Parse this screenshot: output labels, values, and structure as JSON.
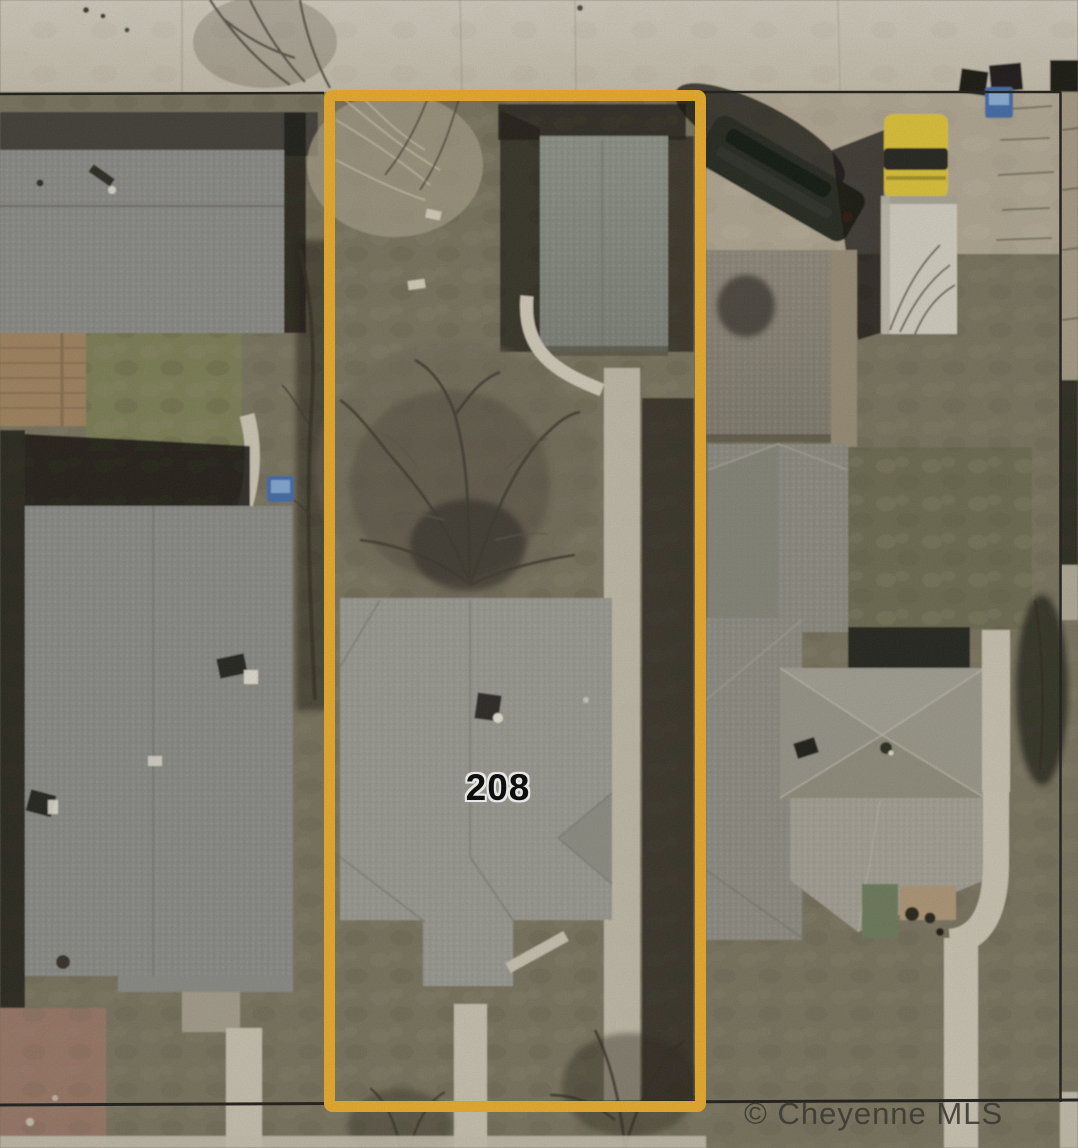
{
  "map": {
    "type": "aerial-parcel-photo",
    "parcel_label": "208",
    "attribution": "© Cheyenne MLS",
    "colors": {
      "parcel_outline": "#F0AF28",
      "boundary_line": "#1C1B17",
      "street": "#CFC7B5",
      "grass": "#79735D",
      "lawn_dark": "#6D6B50",
      "roof_subject": "#9B9B93",
      "roof_garage": "#878C80",
      "roof_neighbor_west": "#8C8C87",
      "roof_neighbor_east": "#9A978A",
      "concrete": "#B3A993",
      "sidewalk": "#CCC5B2",
      "deck_wood": "#A2845D",
      "dirt_red": "#9A7765",
      "truck_yellow": "#E2C634",
      "trailer_white": "#D7D2C3",
      "van_dark": "#23271F",
      "bin_blue": "#3F6CAB",
      "watermark_color": "#35352D",
      "label_color": "#000000"
    },
    "objects": [
      "street",
      "west-neighbor-house",
      "wood-deck",
      "subject-parcel-outline",
      "subject-garage",
      "subject-house-roof",
      "large-bare-tree",
      "front-sidewalk",
      "east-neighbor-shed",
      "east-neighbor-house",
      "dark-van",
      "yellow-truck",
      "blue-trash-bin",
      "boundary-lines",
      "attribution-watermark",
      "parcel-number-label"
    ]
  }
}
